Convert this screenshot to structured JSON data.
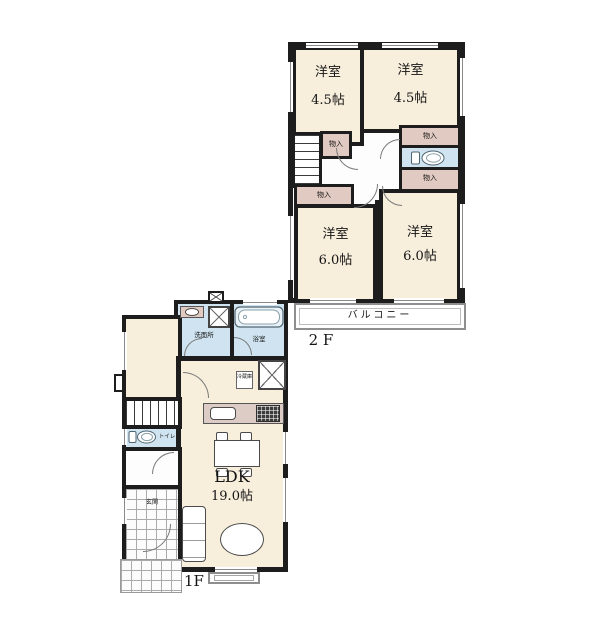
{
  "plan": {
    "floor2": {
      "label": "2 F",
      "balcony": "バルコニー",
      "closet": "物入",
      "room_tl": {
        "name": "洋室",
        "size": "4.5帖"
      },
      "room_tr": {
        "name": "洋室",
        "size": "4.5帖"
      },
      "room_bl": {
        "name": "洋室",
        "size": "6.0帖"
      },
      "room_br": {
        "name": "洋室",
        "size": "6.0帖"
      }
    },
    "floor1": {
      "label": "1F",
      "ldk_name": "LDK",
      "ldk_size": "19.0帖",
      "washroom": "洗面所",
      "bath": "浴室",
      "toilet": "トイレ",
      "entrance": "玄関",
      "fridge": "冷蔵庫"
    },
    "colors": {
      "wall": "#1d1d1e",
      "room_fill": "#f7eedc",
      "closet_fill": "#e1cac1",
      "water_fill": "#cfe4f0",
      "counter_fill": "#ddccc5"
    }
  }
}
